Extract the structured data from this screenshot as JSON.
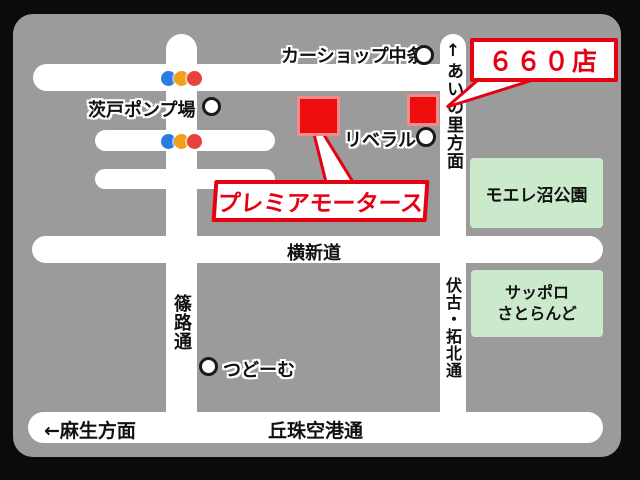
{
  "badge": {
    "text": "６６０店"
  },
  "dealer": {
    "name": "プレミアモータース"
  },
  "landmarks": {
    "car_shop_nakajo": "カーショップ中条",
    "barato_pump": "茨戸ポンプ場",
    "liberal": "リベラル",
    "tsudome": "つどーむ"
  },
  "areas": {
    "moere_park": "モエレ沼公園",
    "satoland_line1": "サッポロ",
    "satoland_line2": "さとらんど"
  },
  "roads": {
    "ainosato_direction": "↑あいの里方面",
    "yokoshindo": "横新道",
    "shinoro_dori": "篠路通",
    "fushiko_takuhoku_dori": "伏古・拓北通",
    "okadama_airport_dori": "丘珠空港通",
    "asabu_direction": "←麻生方面"
  },
  "colors": {
    "accent_red": "#e60012",
    "square_red": "#ee0d0d",
    "park_green": "#cbe9cb",
    "map_gray": "#9b9b9b",
    "road_white": "#ffffff",
    "traffic_blue": "#2b7cdf",
    "traffic_amber": "#f0a11c",
    "traffic_red": "#e8423c"
  }
}
